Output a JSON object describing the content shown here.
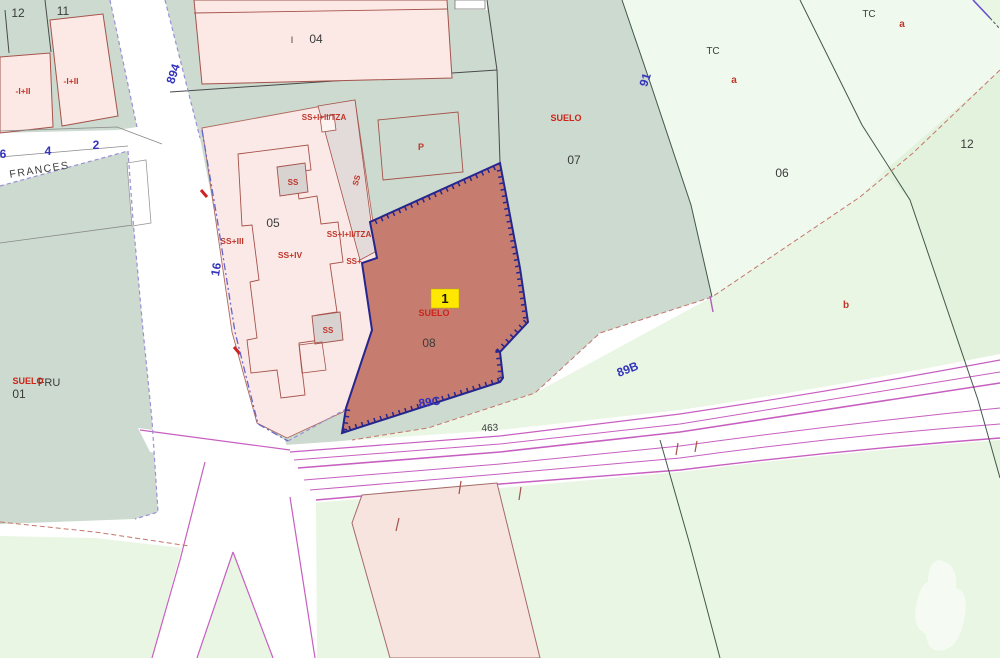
{
  "map": {
    "type": "cadastral-parcel-map",
    "colors": {
      "teal_parcel": "#ccdacf",
      "light_green": "#e9f6e4",
      "lighter_green": "#f0f9ee",
      "green_12": "#e3f2dd",
      "building_pink": "#fce9e6",
      "building_outline": "#a5524a",
      "gray_block": "#d8d2d1",
      "corridor": "#e2dbda",
      "highlight_parcel": "#c67d70",
      "highlight_border": "#26268f",
      "road_magenta": "#c75fc0",
      "badge_bg": "#ffe800"
    },
    "highlight": {
      "parcel_number": "08",
      "badge": "1",
      "land_label": "SUELO"
    },
    "labels": [
      {
        "id": "parcel-12-left",
        "text": "12",
        "kind": "black",
        "x": 18,
        "y": 17,
        "size": 12,
        "rot": 0
      },
      {
        "id": "parcel-11",
        "text": "11",
        "kind": "black",
        "x": 63,
        "y": 15,
        "size": 12,
        "rot": 0
      },
      {
        "id": "parcel-04",
        "text": "04",
        "kind": "black",
        "x": 316,
        "y": 43,
        "size": 12,
        "rot": 0
      },
      {
        "id": "parcel-04-roman",
        "text": "I",
        "kind": "black",
        "x": 292,
        "y": 43,
        "size": 9,
        "rot": 0
      },
      {
        "id": "parcel-05",
        "text": "05",
        "kind": "black",
        "x": 273,
        "y": 227,
        "size": 12,
        "rot": 0
      },
      {
        "id": "parcel-07",
        "text": "07",
        "kind": "black",
        "x": 574,
        "y": 164,
        "size": 12,
        "rot": 0
      },
      {
        "id": "parcel-06",
        "text": "06",
        "kind": "black",
        "x": 782,
        "y": 177,
        "size": 12,
        "rot": 0
      },
      {
        "id": "parcel-12-right",
        "text": "12",
        "kind": "black",
        "x": 967,
        "y": 148,
        "size": 12,
        "rot": 0
      },
      {
        "id": "parcel-08",
        "text": "08",
        "kind": "black",
        "x": 429,
        "y": 347,
        "size": 12,
        "rot": 0
      },
      {
        "id": "parcel-01",
        "text": "01",
        "kind": "black",
        "x": 19,
        "y": 398,
        "size": 12,
        "rot": 0
      },
      {
        "id": "crop-fru",
        "text": "FRU",
        "kind": "black",
        "x": 49,
        "y": 386,
        "size": 11,
        "rot": 0
      },
      {
        "id": "road-463",
        "text": "463",
        "kind": "black",
        "x": 490,
        "y": 431,
        "size": 10,
        "rot": -3
      },
      {
        "id": "street-frances",
        "text": "FRANCES",
        "kind": "black",
        "x": 40,
        "y": 173,
        "size": 10.5,
        "rot": -9,
        "ls": 1.5
      },
      {
        "id": "zone-tc-1",
        "text": "TC",
        "kind": "black",
        "x": 713,
        "y": 54,
        "size": 10,
        "rot": 0
      },
      {
        "id": "zone-tc-2",
        "text": "TC",
        "kind": "black",
        "x": 869,
        "y": 17,
        "size": 10,
        "rot": 0
      },
      {
        "id": "const-1",
        "text": "-I+II",
        "kind": "red",
        "x": 23,
        "y": 94,
        "size": 8.5,
        "rot": 0
      },
      {
        "id": "const-2",
        "text": "-I+II",
        "kind": "red",
        "x": 71,
        "y": 84,
        "size": 8.5,
        "rot": 0
      },
      {
        "id": "const-3",
        "text": "SS+I+II/TZA",
        "kind": "red",
        "x": 324,
        "y": 120,
        "size": 8,
        "rot": 0
      },
      {
        "id": "const-4",
        "text": "SS+I+II/TZA",
        "kind": "red",
        "x": 349,
        "y": 237,
        "size": 8,
        "rot": 0
      },
      {
        "id": "const-5",
        "text": "SS+III",
        "kind": "red",
        "x": 232,
        "y": 244,
        "size": 8.5,
        "rot": 0
      },
      {
        "id": "const-6",
        "text": "SS+IV",
        "kind": "red",
        "x": 290,
        "y": 258,
        "size": 8.5,
        "rot": 0
      },
      {
        "id": "const-7",
        "text": "SS+",
        "kind": "red",
        "x": 354,
        "y": 264,
        "size": 8,
        "rot": 0
      },
      {
        "id": "const-8",
        "text": "SS",
        "kind": "red",
        "x": 293,
        "y": 185,
        "size": 8,
        "rot": 0
      },
      {
        "id": "const-9",
        "text": "SS",
        "kind": "red",
        "x": 328,
        "y": 333,
        "size": 8,
        "rot": 0
      },
      {
        "id": "const-10",
        "text": "SS",
        "kind": "red",
        "x": 359,
        "y": 181,
        "size": 8,
        "rot": -75
      },
      {
        "id": "suelo-07",
        "text": "SUELO",
        "kind": "suelo",
        "x": 566,
        "y": 121,
        "size": 9,
        "rot": 0
      },
      {
        "id": "suelo-08",
        "text": "SUELO",
        "kind": "suelo",
        "x": 434,
        "y": 316,
        "size": 9,
        "rot": 0
      },
      {
        "id": "suelo-01",
        "text": "SUELO",
        "kind": "suelo",
        "x": 28,
        "y": 384,
        "size": 9,
        "rot": 0
      },
      {
        "id": "const-p",
        "text": "P",
        "kind": "red",
        "x": 421,
        "y": 150,
        "size": 9,
        "rot": 0
      },
      {
        "id": "zone-a-1",
        "text": "a",
        "kind": "red",
        "x": 734,
        "y": 83,
        "size": 10,
        "rot": 0
      },
      {
        "id": "zone-a-2",
        "text": "a",
        "kind": "red",
        "x": 902,
        "y": 27,
        "size": 10,
        "rot": 0
      },
      {
        "id": "zone-b",
        "text": "b",
        "kind": "red",
        "x": 846,
        "y": 308,
        "size": 10,
        "rot": 0
      },
      {
        "id": "highlight-badge-number",
        "text": "1",
        "kind": "badge",
        "x": 445,
        "y": 303,
        "size": 13,
        "rot": 0
      },
      {
        "id": "road-894",
        "text": "894",
        "kind": "blue",
        "x": 177,
        "y": 75,
        "size": 12,
        "rot": -72
      },
      {
        "id": "road-16",
        "text": "16",
        "kind": "blue",
        "x": 220,
        "y": 270,
        "size": 12,
        "rot": -80
      },
      {
        "id": "road-91",
        "text": "91",
        "kind": "blue",
        "x": 649,
        "y": 81,
        "size": 12,
        "rot": -72
      },
      {
        "id": "road-89b",
        "text": "89B",
        "kind": "blue",
        "x": 629,
        "y": 373,
        "size": 12,
        "rot": -21
      },
      {
        "id": "road-89c",
        "text": "89C",
        "kind": "blue",
        "x": 430,
        "y": 406,
        "size": 12,
        "rot": -8
      },
      {
        "id": "portal-6",
        "text": "6",
        "kind": "blue",
        "x": 3,
        "y": 158,
        "size": 12,
        "rot": 0
      },
      {
        "id": "portal-4",
        "text": "4",
        "kind": "blue",
        "x": 48,
        "y": 155,
        "size": 12,
        "rot": 0
      },
      {
        "id": "portal-2",
        "text": "2",
        "kind": "blue",
        "x": 96,
        "y": 149,
        "size": 12,
        "rot": 0
      }
    ]
  }
}
